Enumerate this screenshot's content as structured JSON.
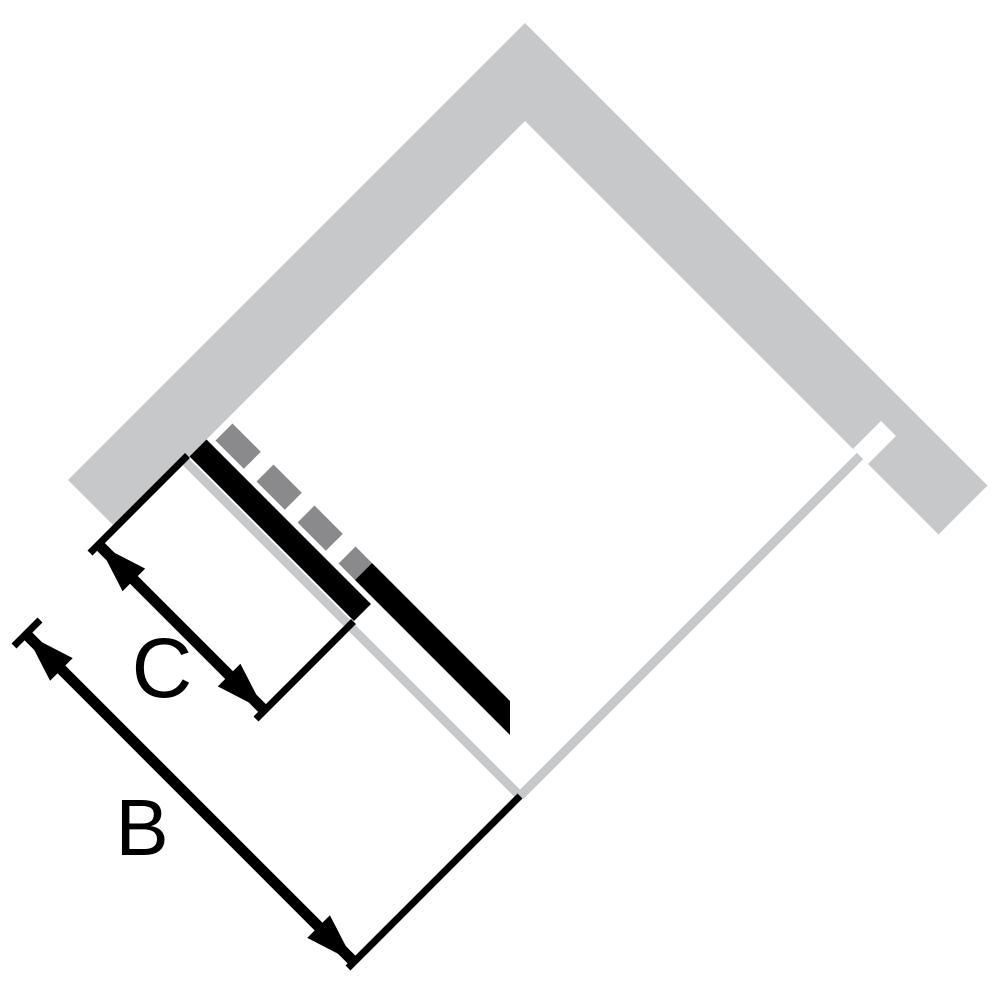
{
  "diagram": {
    "type": "shower-enclosure-dimension-diagram",
    "view": "top-down corner enclosure rotated 45 degrees",
    "labels": {
      "overall_width": "B",
      "panel_width": "C"
    },
    "colors": {
      "wall": "#c7c8ca",
      "glass": "#c7c8ca",
      "door_track_dash": "#8a8a8c",
      "ink": "#000000",
      "background": "#ffffff"
    },
    "elements": {
      "walls": "two thick gray bands meeting at top corner",
      "glass_outline": "thin gray lines forming lower diamond sides",
      "door": "black panel, dashed section shows slide track position",
      "dimension_b": "overall opening width along lower-left side",
      "dimension_c": "sliding panel width"
    }
  }
}
